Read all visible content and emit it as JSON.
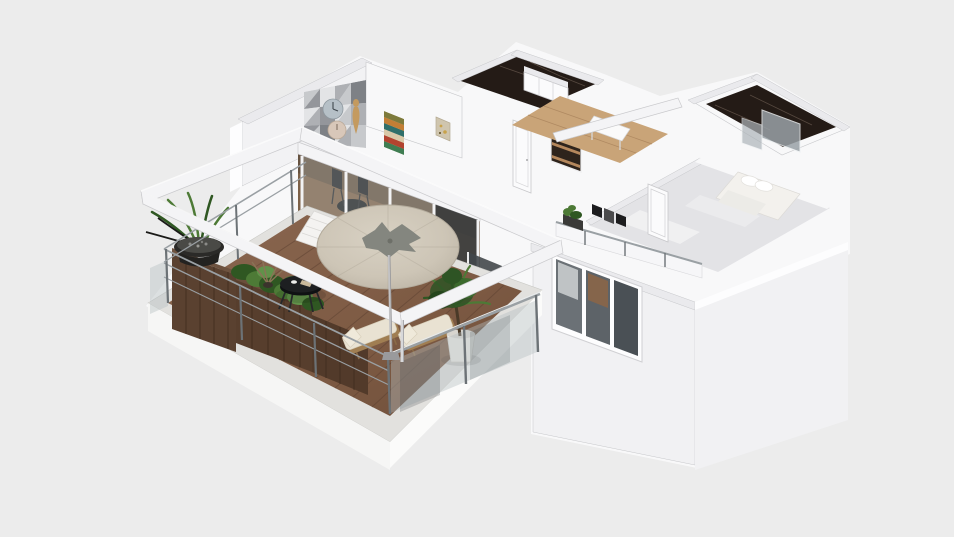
{
  "app": {
    "view": "3d-floorplan-viewport"
  },
  "palette": {
    "background": "#ececec",
    "wall-white": "#f8f8f9",
    "wall-top": "#eaeaed",
    "wall-shade": "#f1f1f3",
    "wall-interior": "#f2f2f4",
    "edge-line": "#c6c7ca",
    "beam-white": "#f4f4f6",
    "terrace-rim": "#e2e1de",
    "base-face": "#f6f6f5",
    "deck-wood": "#7d5a43",
    "deck-line": "#5e4232",
    "planter-wood": "#5a4130",
    "planter-dark": "#3f2c1e",
    "plant-green": "#4d7a36",
    "plant-dark": "#2f5722",
    "umbrella-canopy": "#cdc5b6",
    "umbrella-shade": "#b3ab9c",
    "umbrella-leaf": "#84867f",
    "marble-dark": "#241b16",
    "marble-vein": "#8a776a",
    "oak-floor": "#c9a478",
    "oak-line": "#a9835c",
    "glass-tint": "#b4bec2",
    "glass-dark": "#43474a",
    "metal-rail": "#9aa0a4",
    "metal-post": "#6c7276",
    "table-black": "#1d1f21",
    "cushion-cream": "#e9e2d2",
    "lounger-wood": "#a07e52",
    "bed-white": "#f3f1ed",
    "bedroom-floor": "#e3e3e6",
    "pot-white": "#eceae6",
    "pot-dark": "#2b2a28",
    "door-white": "#fbfbfc",
    "interior-wood": "#7d6148",
    "window-glass": "#585f64",
    "curtain": "#d7d9da",
    "shower-glass": "#9aa2a7",
    "gold-art": "#c8a24a",
    "art-green": "#3f7d52",
    "art-red": "#b2432f",
    "art-cream": "#d9c9a8",
    "art-teal": "#2f6f6a",
    "art-rust": "#c27e35",
    "art-olive": "#7d7a3c",
    "mosaic-1": "#e3e4e6",
    "mosaic-2": "#c7c9cc",
    "mosaic-3": "#aeb0b4",
    "mosaic-4": "#94969b",
    "mosaic-5": "#7e8186",
    "clock-blue": "#b6c0c7",
    "clock-pink": "#d8c7b9"
  },
  "scene_objects": [
    "terrace-deck",
    "wood-planter-boxes",
    "potted-agave",
    "shrub-planter",
    "coffee-table",
    "stacked-lounger",
    "sun-lounger",
    "sun-lounger",
    "potted-tree",
    "glass-railing",
    "metal-railing",
    "pergola-frame",
    "patio-umbrella",
    "living-room",
    "geometric-accent-wall",
    "wall-clocks",
    "chevron-artwork",
    "gold-artwork",
    "dining-set",
    "sliding-glass-doors",
    "closet-room",
    "wardrobe",
    "shelf-unit",
    "hallway-oak-floor",
    "console-table",
    "marble-bathroom",
    "glass-shower",
    "bedroom",
    "double-bed",
    "interior-door",
    "gallery-frames",
    "balcony-railing",
    "balcony-plant",
    "exterior-wall",
    "triple-window"
  ]
}
